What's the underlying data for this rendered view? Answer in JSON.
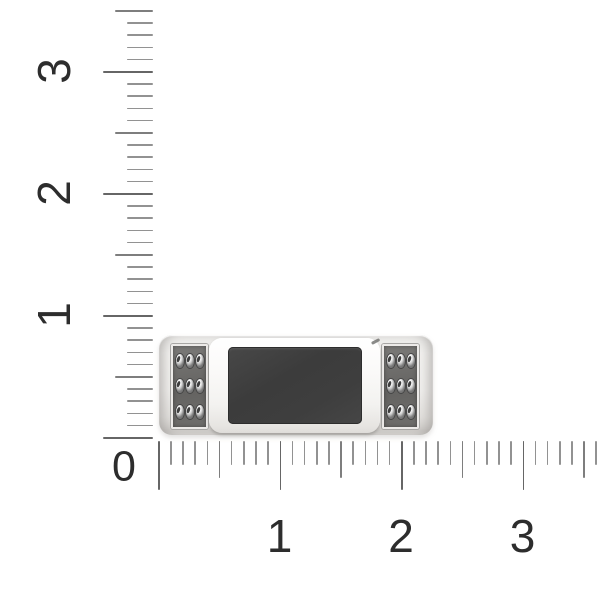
{
  "scene": {
    "background_color": "#ffffff"
  },
  "rulers": {
    "origin_label": "0",
    "label_color": "#2d2d2d",
    "tick_colors": {
      "minor": "#929292",
      "medium": "#7e7e7e",
      "major": "#666666"
    },
    "vertical": {
      "tick_count": 36,
      "labels": [
        {
          "text": "3",
          "tick": 5
        },
        {
          "text": "2",
          "tick": 15
        },
        {
          "text": "1",
          "tick": 25
        }
      ]
    },
    "horizontal": {
      "tick_count": 37,
      "labels": [
        {
          "text": "1",
          "tick": 10
        },
        {
          "text": "2",
          "tick": 20
        },
        {
          "text": "3",
          "tick": 30
        }
      ]
    }
  },
  "product": {
    "metal_color": "#f2f1ef",
    "inlay_color": "#3e3d3d",
    "panel_color": "#6b6a68",
    "gem_color": "#e9e9e9",
    "gem_grid": {
      "rows": 3,
      "cols": 3
    },
    "side_panels": 2
  }
}
